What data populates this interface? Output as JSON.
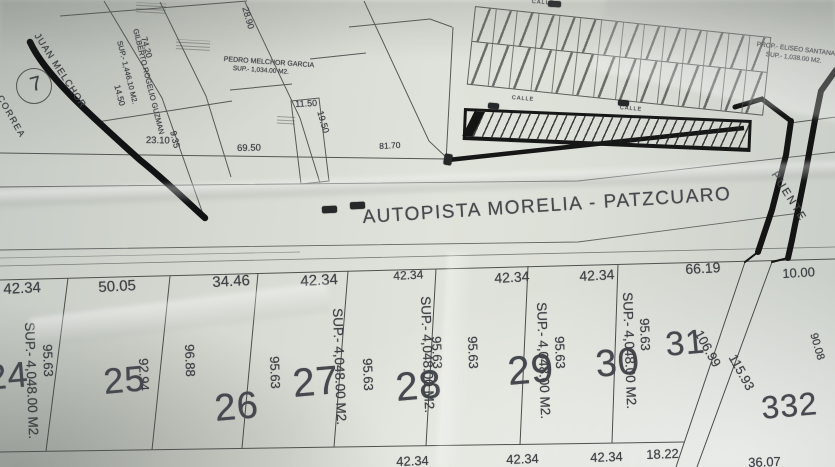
{
  "map": {
    "title_road": "AUTOPISTA MORELIA - PATZCUARO",
    "bridge_label": "PUENTE",
    "landmark_circle": "7",
    "left_road_label": "CORREA",
    "street_labels": [
      "CALLE",
      "CALLE",
      "CALLE"
    ],
    "owners": {
      "juan_melchor": "JUAN MELCHOR",
      "gilberto": "GILBERTO ROGELIO GUZMAN",
      "gilberto_sup": "SUP.- 1,446.10 M2.",
      "pedro_melchor": "PEDRO MELCHOR GARCIA",
      "pedro_melchor_sup": "SUP.- 1,034.00 M2.",
      "prop_right": "PROP.- ELISEO SANTANA",
      "prop_right_sup": "SUP.- 1,038.00 M2."
    },
    "upper_dims": [
      "28.90",
      "74.20",
      "14.50",
      "23.10",
      "9.35",
      "11.50",
      "19.50",
      "69.50",
      "81.70"
    ],
    "top_dims": [
      "42.34",
      "50.05",
      "34.46",
      "42.34",
      "42.34",
      "42.34",
      "42.34",
      "66.19",
      "10.00"
    ],
    "side_dims": [
      "95.63",
      "92.94",
      "96.88",
      "95.63",
      "95.63",
      "95.63",
      "95.63",
      "95.63",
      "95.63"
    ],
    "bottom_dims": [
      "42.34",
      "42.34",
      "42.34",
      "18.22",
      "36.07"
    ],
    "diag_dims": [
      "106.99",
      "115.93",
      "90.08"
    ],
    "lots": [
      {
        "number": "24",
        "sup": "SUP.- 4,048.00 M2."
      },
      {
        "number": "25",
        "sup": ""
      },
      {
        "number": "26",
        "sup": ""
      },
      {
        "number": "27",
        "sup": "SUP.- 4,048.00 M2."
      },
      {
        "number": "28",
        "sup": "SUP.- 4,048.00 M2."
      },
      {
        "number": "29",
        "sup": "SUP.- 4,048.00 M2."
      },
      {
        "number": "30",
        "sup": "SUP.- 4,048.00 M2."
      },
      {
        "number": "31",
        "sup": ""
      },
      {
        "number": "332",
        "sup": ""
      }
    ],
    "subdivision": {
      "rows": 2,
      "cols": 14
    }
  }
}
